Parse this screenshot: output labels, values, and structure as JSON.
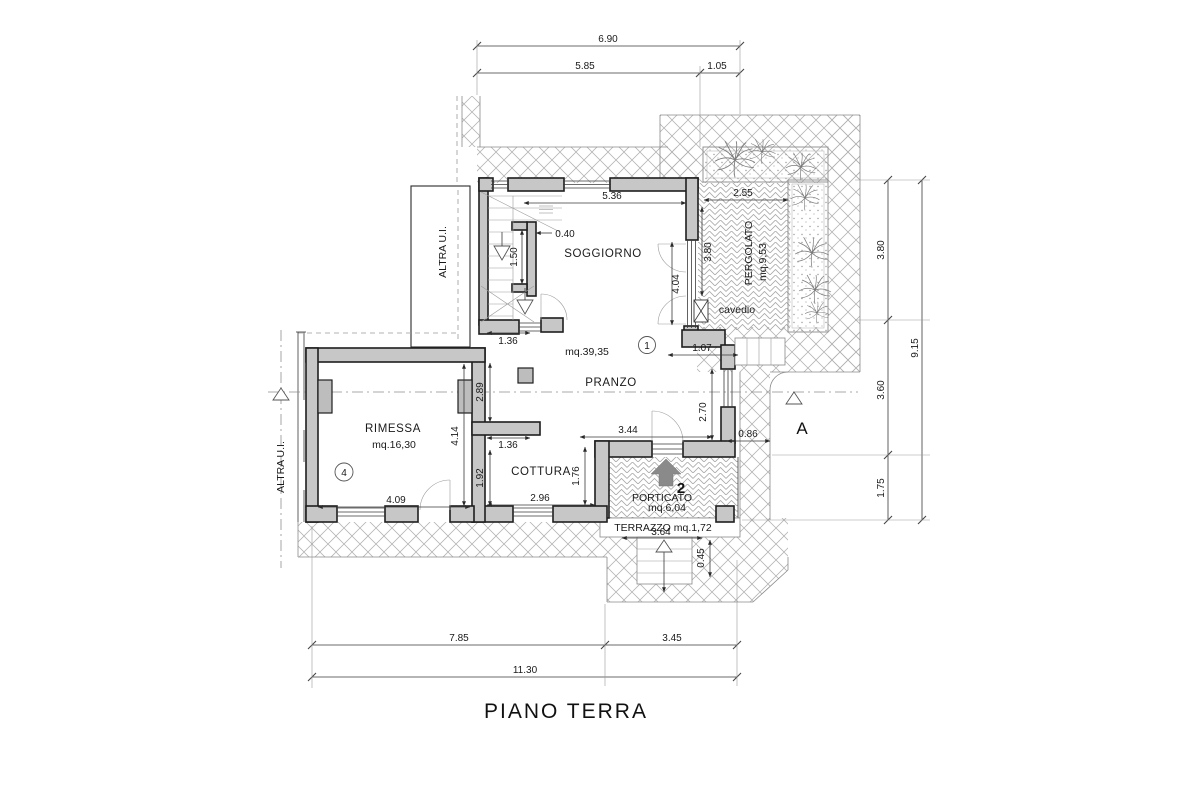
{
  "plan": {
    "title": "PIANO TERRA",
    "labels": {
      "altra_ui_top": "ALTRA U.I.",
      "altra_ui_left": "ALTRA U.I.",
      "section_a": "A"
    },
    "rooms": {
      "soggiorno": {
        "name": "SOGGIORNO"
      },
      "pranzo": {
        "name": "PRANZO",
        "area": "mq.39,35",
        "ref": "1"
      },
      "cottura": {
        "name": "COTTURA"
      },
      "rimessa": {
        "name": "RIMESSA",
        "area": "mq.16,30",
        "ref": "4"
      },
      "pergolato": {
        "name": "PERGOLATO",
        "area": "mq.9,53"
      },
      "porticato": {
        "name": "PORTICATO",
        "area": "mq.6,04",
        "entrance_ref": "2"
      },
      "terrazzo": {
        "name": "TERRAZZO mq.1,72"
      },
      "cavedio": {
        "name": "cavedio"
      }
    },
    "dims": {
      "top_total": "6.90",
      "top_a": "5.85",
      "top_b": "1.05",
      "right_a": "3.80",
      "right_b": "3.60",
      "right_c": "1.75",
      "right_total": "9.15",
      "bottom_a": "7.85",
      "bottom_b": "3.45",
      "bottom_total": "11.30",
      "soggiorno_w": "5.36",
      "pergolato_w": "2.55",
      "pergolato_h": "3.80",
      "soggiorno_h": "4.04",
      "stair_niche": "0.40",
      "stair_wall": "1.50",
      "stair_door": "1.36",
      "pranzo_wall": "2.89",
      "cottura_pass": "1.36",
      "cottura_wall": "1.92",
      "rimessa_w": "4.09",
      "rimessa_h": "4.14",
      "cottura_w": "2.96",
      "porticato_h": "1.76",
      "pranzo_door": "3.44",
      "step_side": "2.70",
      "step_top": "1.07",
      "step_w": "0.86",
      "terrazzo_w": "3.64",
      "step_h": "0.45"
    },
    "colors": {
      "wall_fill": "#c7c7c7",
      "line": "#1e1e1e",
      "hatch": "#b3b3b3",
      "arrow": "#8a8a8a"
    }
  }
}
